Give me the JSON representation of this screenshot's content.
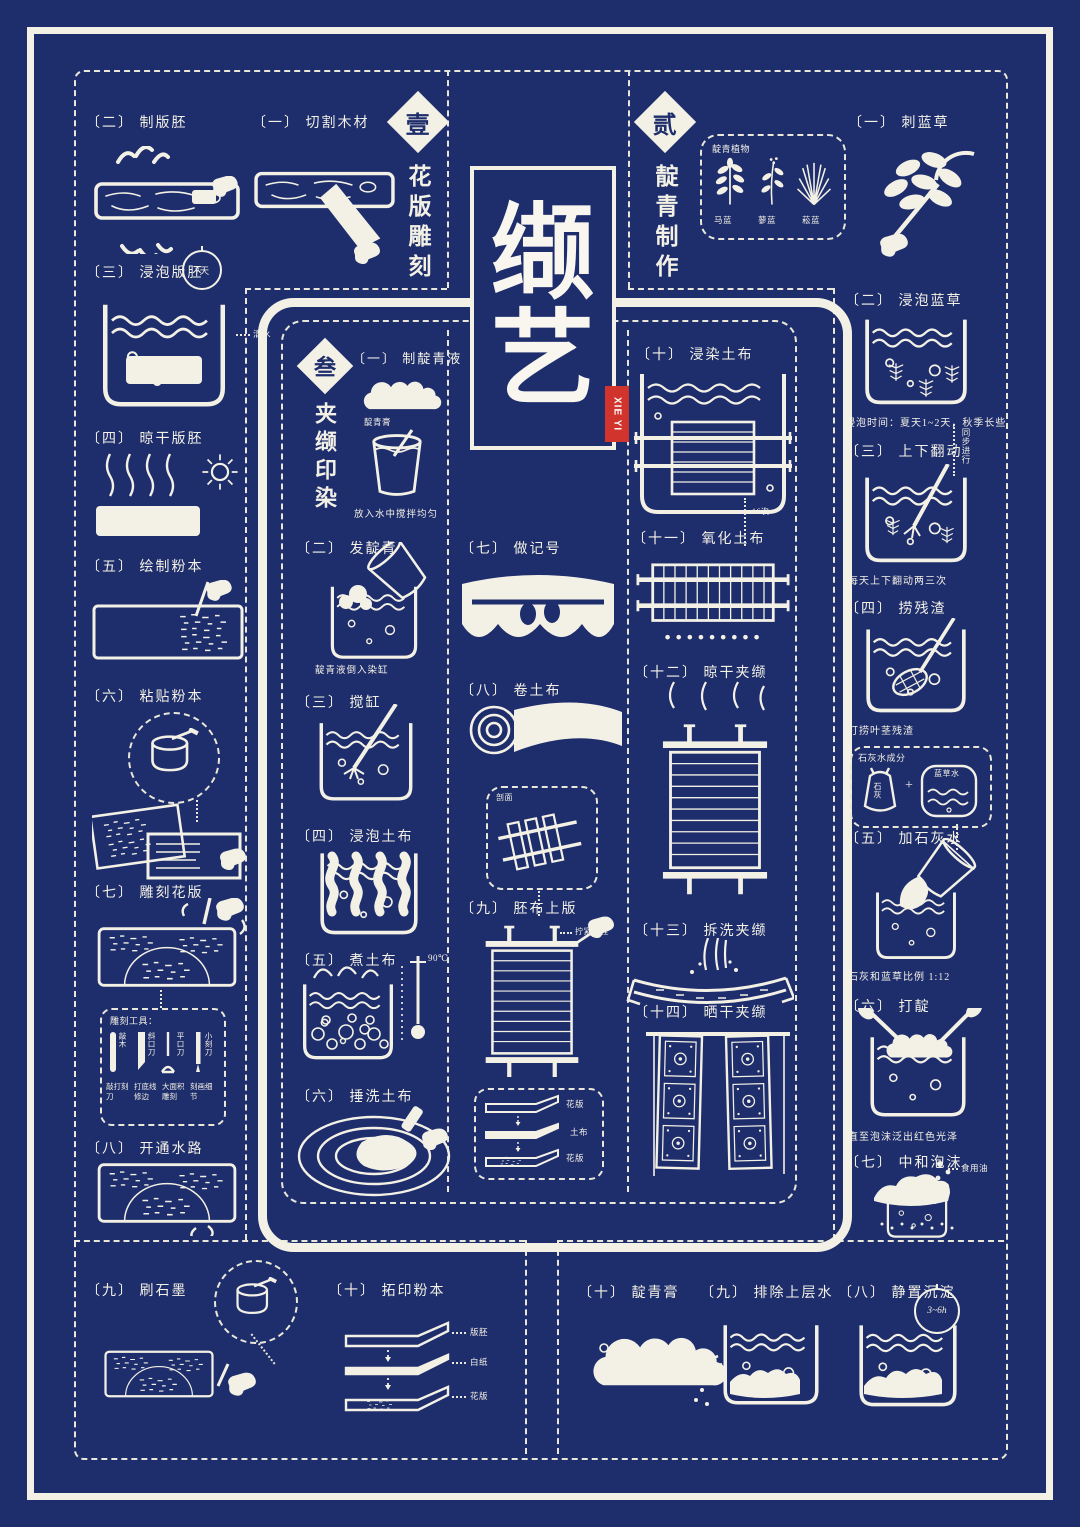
{
  "poster": {
    "bg": "#1e2d6b",
    "white": "#f3f1e6",
    "red": "#d0342c"
  },
  "logo": {
    "char_top": "缬",
    "char_bottom": "艺",
    "tag": "XIE YI"
  },
  "sec1": {
    "num": "壹",
    "title": "花版雕刻",
    "s1": "〔一〕 切割木材",
    "s2": "〔二〕 制版胚",
    "s3": "〔三〕 浸泡版胚",
    "s3_badge": "7天",
    "s3_note": "清水",
    "s4": "〔四〕 晾干版胚",
    "s5": "〔五〕 绘制粉本",
    "s6": "〔六〕 粘贴粉本",
    "s7": "〔七〕 雕刻花版",
    "tools_label": "雕刻工具：",
    "tools": [
      {
        "name": "敲木",
        "use": "敲打刻刀"
      },
      {
        "name": "斜口刀",
        "use": "打底线修边"
      },
      {
        "name": "平口刀",
        "use": "大面积雕刻"
      },
      {
        "name": "小刻刀",
        "use": "刻画细节"
      }
    ],
    "s8": "〔八〕 开通水路",
    "s9": "〔九〕 刷石墨",
    "s10": "〔十〕 拓印粉本",
    "layers": [
      "版胚",
      "白纸",
      "花版"
    ]
  },
  "sec2": {
    "num": "贰",
    "title": "靛青制作",
    "plants_label": "靛青植物",
    "plants": [
      "马蓝",
      "蓼蓝",
      "菘蓝"
    ],
    "s1": "〔一〕 刺蓝草",
    "s2": "〔二〕 浸泡蓝草",
    "s2_note": "浸泡时间：夏天1~2天，秋季长些",
    "s3": "〔三〕 上下翻动",
    "s3_side": "同步进行",
    "s3_note": "每天上下翻动两三次",
    "s4": "〔四〕 捞残渣",
    "s4_note": "打捞叶茎残渣",
    "lime_label": "石灰水成分",
    "lime_a": "石灰",
    "lime_plus": "+",
    "lime_b": "蓝草水",
    "s5": "〔五〕 加石灰水",
    "s5_note": "石灰和蓝草比例 1:12",
    "s6": "〔六〕 打靛",
    "s6_note": "直至泡沫泛出红色光泽",
    "s7": "〔七〕 中和泡沫",
    "s7_note": "食用油",
    "s8": "〔八〕 静置沉淀",
    "s8_badge": "3~6h",
    "s9": "〔九〕 排除上层水",
    "s10": "〔十〕 靛青膏"
  },
  "sec3": {
    "num": "叁",
    "title": "夹缬印染",
    "s1": "〔一〕 制靛青液",
    "s1_cloud": "靛青膏",
    "s1_note": "放入水中搅拌均匀",
    "s2": "〔二〕 发靛青",
    "s2_note": "靛青液倒入染缸",
    "s3": "〔三〕 搅缸",
    "s4": "〔四〕 浸泡土布",
    "s5": "〔五〕 煮土布",
    "s5_temp": "90℃",
    "s6": "〔六〕 捶洗土布",
    "s7": "〔七〕 做记号",
    "s8": "〔八〕 卷土布",
    "s9": "〔九〕 胚布上版",
    "s9_inset": "剖面",
    "s9_note": "拧紧螺栓",
    "sandwich": [
      "花版",
      "土布",
      "花版"
    ],
    "s10": "〔十〕 浸染土布",
    "s11": "〔十一〕 氧化土布",
    "s11_note": "16次",
    "s12": "〔十二〕 晾干夹缬",
    "s13": "〔十三〕 拆洗夹缬",
    "s14": "〔十四〕 晒干夹缬"
  }
}
